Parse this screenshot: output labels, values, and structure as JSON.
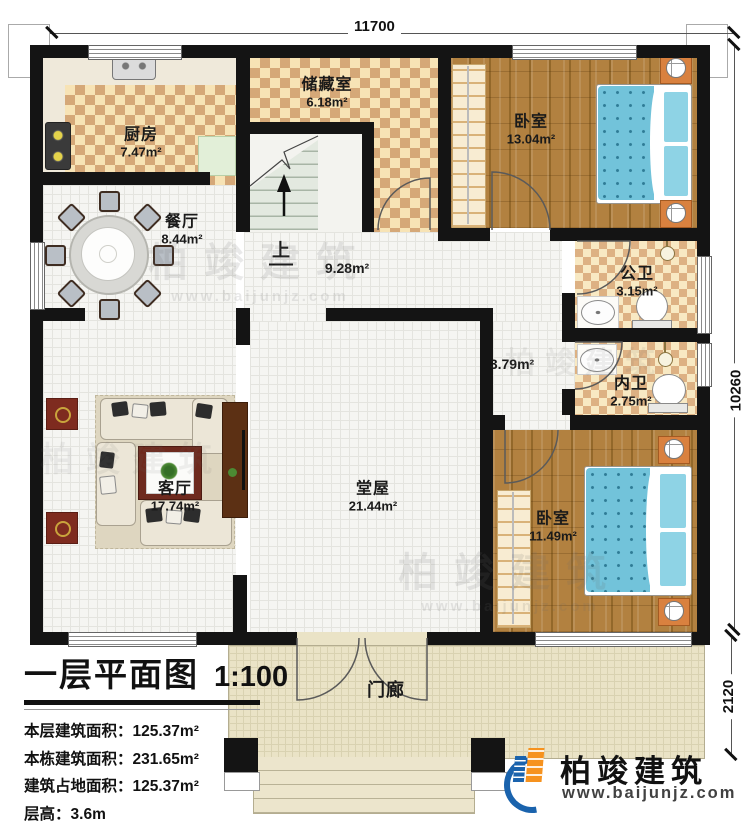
{
  "plan": {
    "dimensions": {
      "top": "11700",
      "right": "10260",
      "porch_depth": "2120"
    },
    "rooms": [
      {
        "name": "厨房",
        "area": "7.47m²"
      },
      {
        "name": "储藏室",
        "area": "6.18m²"
      },
      {
        "name": "卧室",
        "area": "13.04m²"
      },
      {
        "name": "餐厅",
        "area": "8.44m²"
      },
      {
        "name": "",
        "area": "9.28m²"
      },
      {
        "name": "公卫",
        "area": "3.15m²"
      },
      {
        "name": "内卫",
        "area": "2.75m²"
      },
      {
        "name": "",
        "area": "3.79m²"
      },
      {
        "name": "客厅",
        "area": "17.74m²"
      },
      {
        "name": "堂屋",
        "area": "21.44m²"
      },
      {
        "name": "卧室",
        "area": "11.49m²"
      },
      {
        "name": "门廊",
        "area": ""
      }
    ],
    "stairs_up_label": "上"
  },
  "title_block": {
    "title": "一层平面图",
    "scale": "1:100",
    "stats": [
      {
        "label": "本层建筑面积：",
        "value": "125.37m²"
      },
      {
        "label": "本栋建筑面积：",
        "value": "231.65m²"
      },
      {
        "label": "建筑占地面积：",
        "value": "125.37m²"
      },
      {
        "label": "层高：",
        "value": "3.6m"
      }
    ]
  },
  "branding": {
    "company": "柏竣建筑",
    "website": "www.baijunjz.com"
  },
  "watermark": {
    "company": "柏竣建筑",
    "website": "www.baijunjz.com"
  }
}
